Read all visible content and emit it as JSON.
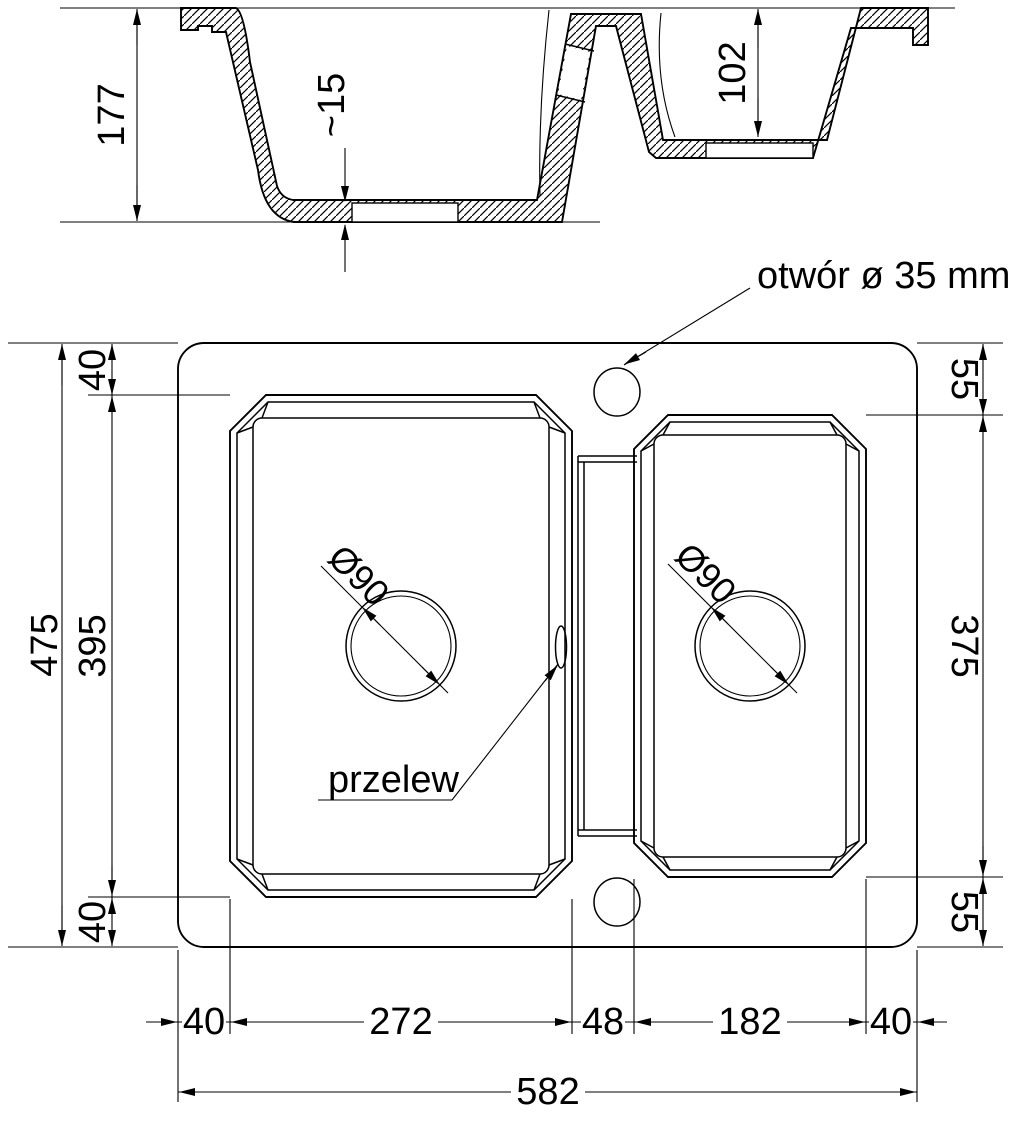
{
  "drawing": {
    "section": {
      "total_depth": "177",
      "bottom_clearance": "~15",
      "small_bowl_depth": "102"
    },
    "plan": {
      "tap_hole_label": "otwór ø 35 mm",
      "overflow_label": "przelew",
      "main_drain_diameter": "Ø90",
      "small_drain_diameter": "Ø90",
      "left_dims": {
        "total_depth_front_back": "475",
        "top_margin": "40",
        "main_bowl_length": "395",
        "bottom_margin": "40"
      },
      "right_dims": {
        "top_margin": "55",
        "small_bowl_length": "375",
        "bottom_margin": "55"
      },
      "bottom_dims": {
        "left_margin": "40",
        "main_bowl_width": "272",
        "divider_width": "48",
        "small_bowl_width": "182",
        "right_margin": "40",
        "total_width": "582"
      }
    }
  }
}
